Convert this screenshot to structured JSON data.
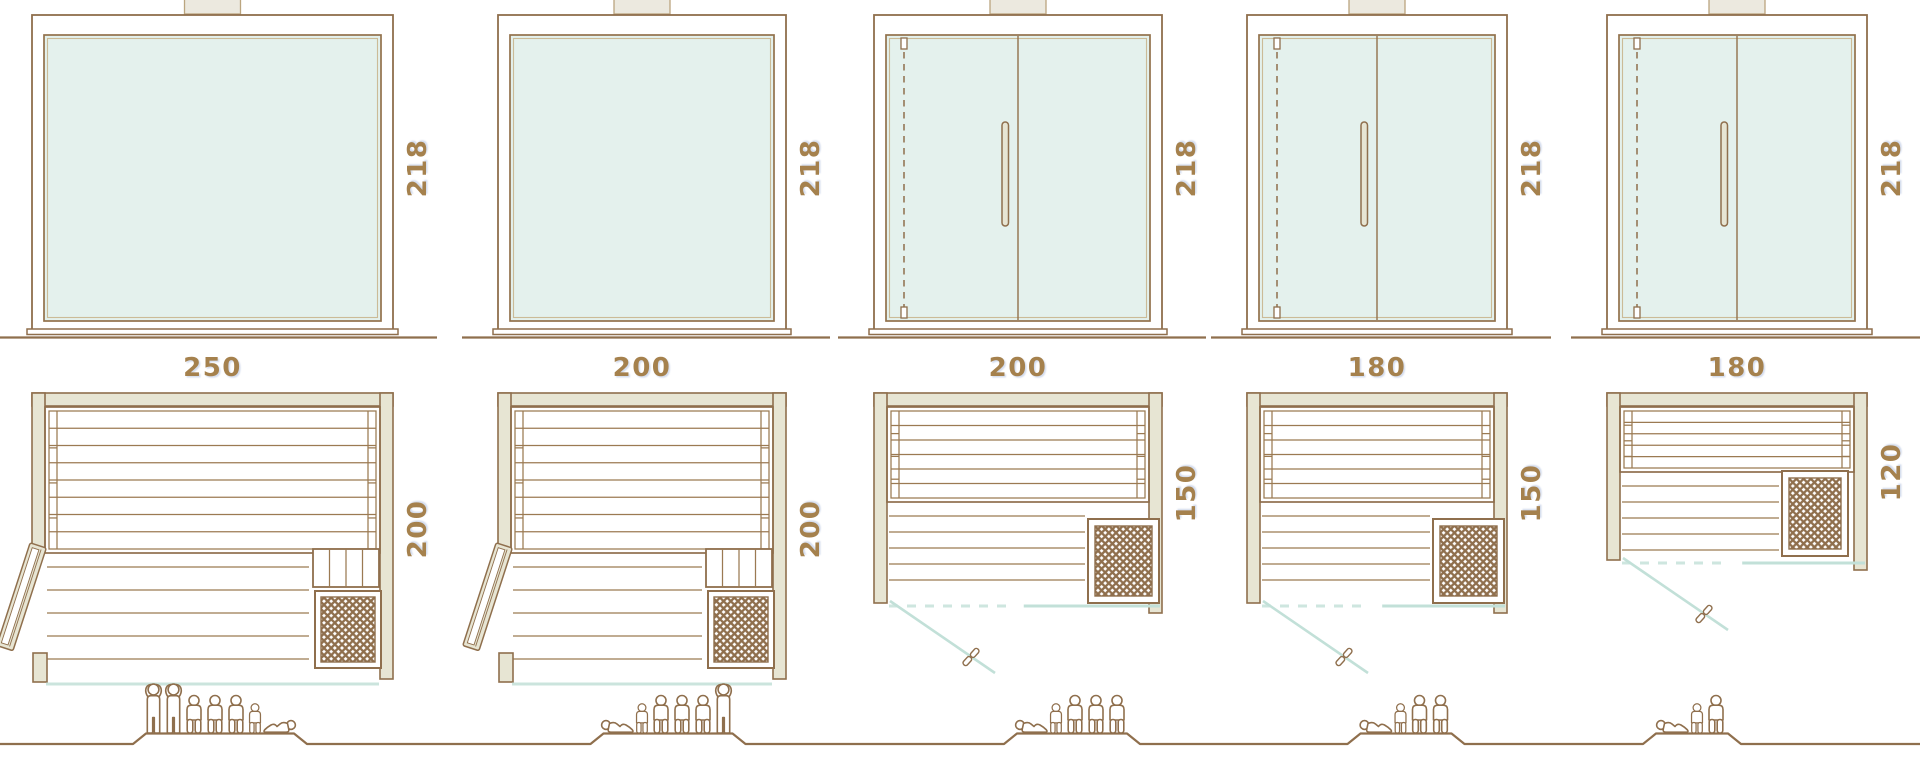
{
  "diagram": {
    "kind": "sauna-cabin size comparison — front elevations, floor plans and capacity figures",
    "colors": {
      "outline_brown": "#8f6f4d",
      "board_line_brown": "#9b7a52",
      "wall_beige": "#e7e5d3",
      "glass_mint": "#e4f1ed",
      "glass_teal_line": "#c2e0d8",
      "dimension_label": "#a5814d",
      "background": "#ffffff"
    },
    "units": [
      {
        "width_label": "250",
        "height_label": "218",
        "depth_label": "200",
        "elevation_type": "fixed-glass-front",
        "plan_door": "side",
        "capacity": 7,
        "people": [
          "standing",
          "standing",
          "seated",
          "seated",
          "seated",
          "child",
          "reclining-right"
        ]
      },
      {
        "width_label": "200",
        "height_label": "218",
        "depth_label": "200",
        "elevation_type": "fixed-glass-front",
        "plan_door": "side",
        "capacity": 6,
        "people": [
          "reclining-left",
          "child",
          "seated",
          "seated",
          "seated",
          "standing"
        ]
      },
      {
        "width_label": "200",
        "height_label": "218",
        "depth_label": "150",
        "elevation_type": "double-door-glass-front",
        "plan_door": "front",
        "capacity": 5,
        "people": [
          "reclining-left",
          "child",
          "seated",
          "seated",
          "seated"
        ]
      },
      {
        "width_label": "180",
        "height_label": "218",
        "depth_label": "150",
        "elevation_type": "double-door-glass-front",
        "plan_door": "front",
        "capacity": 4,
        "people": [
          "reclining-left",
          "child",
          "seated",
          "seated"
        ]
      },
      {
        "width_label": "180",
        "height_label": "218",
        "depth_label": "120",
        "elevation_type": "double-door-glass-front",
        "plan_door": "front",
        "capacity": 3,
        "people": [
          "reclining-left",
          "child",
          "seated"
        ]
      }
    ]
  }
}
